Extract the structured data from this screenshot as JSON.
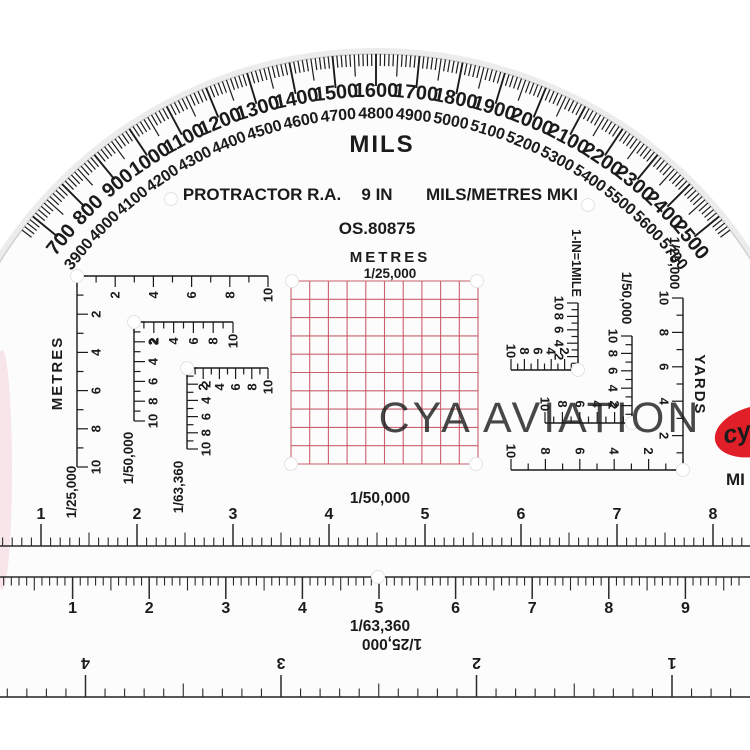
{
  "product": {
    "type_label": "MILS",
    "name": "PROTRACTOR R.A.",
    "size": "9 IN",
    "spec": "MILS/METRES MKI",
    "model": "OS.80875"
  },
  "arc": {
    "outer_labels_start": 700,
    "outer_labels_end": 2500,
    "label_step": 100,
    "back_bearing_offset": 3200,
    "minor_tick_mils": 10,
    "medium_tick_mils": 50,
    "major_tick_mils": 100
  },
  "romer_grid": {
    "title": "METRES",
    "scale": "1/25,000",
    "rows": 10,
    "cols": 10
  },
  "left_scales": [
    {
      "axis_label": "METRES",
      "scale": "1/25,000",
      "numbers": [
        2,
        4,
        6,
        8,
        10
      ]
    },
    {
      "scale": "1/50,000",
      "numbers": [
        2,
        4,
        6,
        8,
        10
      ]
    },
    {
      "scale": "1/63,360",
      "numbers": [
        2,
        4,
        6,
        8,
        10
      ]
    }
  ],
  "right_scales": [
    {
      "scale": "1-IN=1MILE",
      "numbers": [
        2,
        4,
        6,
        8,
        10
      ]
    },
    {
      "scale": "1/50,000",
      "numbers": [
        2,
        4,
        6,
        8,
        10
      ]
    },
    {
      "scale": "1/25,000",
      "axis_label": "YARDS",
      "numbers": [
        2,
        4,
        6,
        8,
        10
      ]
    }
  ],
  "bottom_rulers": [
    {
      "scale": "1/50,000",
      "numbers": [
        1,
        2,
        3,
        4,
        5,
        6,
        7,
        8
      ]
    },
    {
      "scale": "1/63,360",
      "numbers": [
        1,
        2,
        3,
        4,
        5,
        6,
        7,
        8,
        9
      ]
    },
    {
      "scale": "1/25,000",
      "numbers": [
        1,
        2,
        3,
        4
      ],
      "inverted": true
    }
  ],
  "watermark": "CYA AVIATION",
  "logo": {
    "text": "cy",
    "caption": "MI",
    "color": "#e01f28"
  },
  "colors": {
    "print_red": "#d42c35",
    "grid_red": "#c4505e",
    "ink": "#1b1b1b",
    "watermark_gray": "#bdbdbd"
  }
}
